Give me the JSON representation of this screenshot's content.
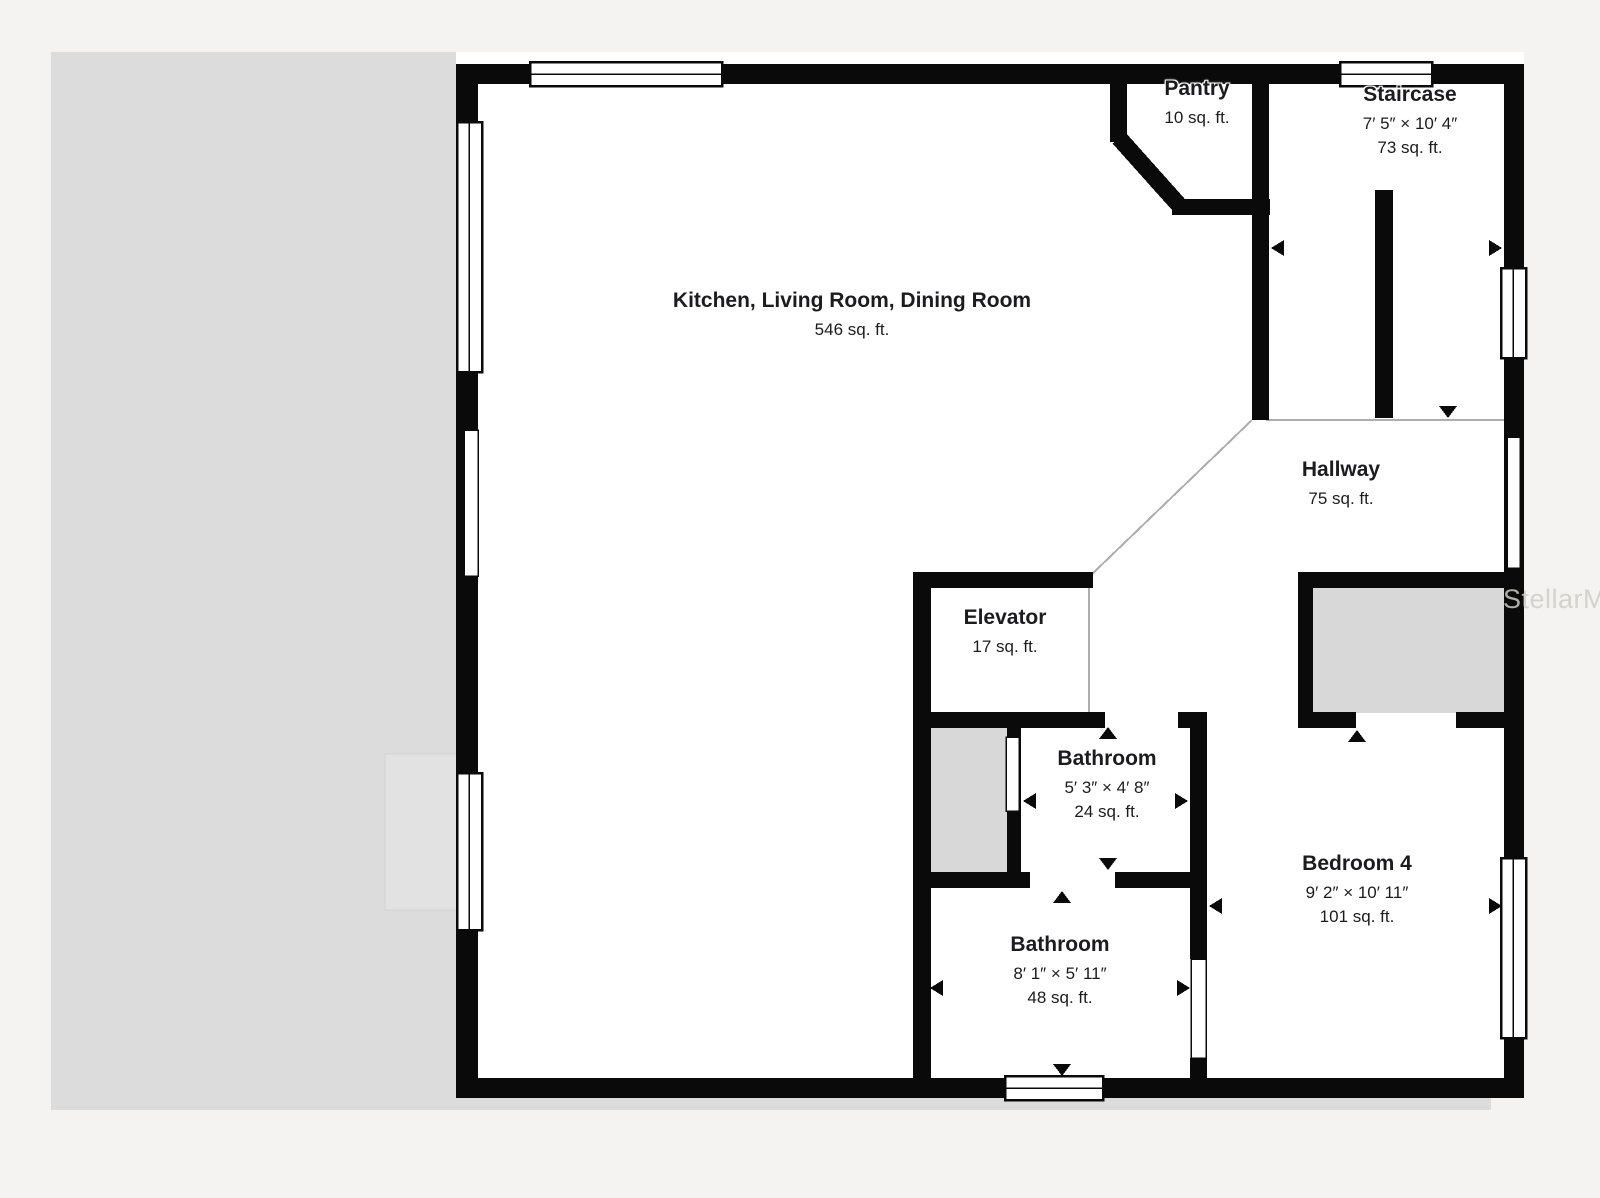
{
  "watermark": "StellarMLS",
  "rooms": [
    {
      "id": "kitchen-living-dining",
      "label": "Kitchen, Living Room, Dining Room",
      "area": "546 sq. ft."
    },
    {
      "id": "pantry",
      "label": "Pantry",
      "area": "10 sq. ft."
    },
    {
      "id": "staircase",
      "label": "Staircase",
      "dims": "7′ 5″ × 10′ 4″",
      "area": "73 sq. ft."
    },
    {
      "id": "hallway",
      "label": "Hallway",
      "area": "75 sq. ft."
    },
    {
      "id": "elevator",
      "label": "Elevator",
      "area": "17 sq. ft."
    },
    {
      "id": "bathroom-small",
      "label": "Bathroom",
      "dims": "5′ 3″ × 4′ 8″",
      "area": "24 sq. ft."
    },
    {
      "id": "bathroom-large",
      "label": "Bathroom",
      "dims": "8′ 1″ × 5′ 11″",
      "area": "48 sq. ft."
    },
    {
      "id": "bedroom-4",
      "label": "Bedroom 4",
      "dims": "9′ 2″ × 10′ 11″",
      "area": "101 sq. ft."
    }
  ],
  "colors": {
    "wall": "#0a0a0a",
    "room_fill": "#ffffff",
    "closet_fill": "#d8d8d8",
    "backdrop_gray": "#dcdcdc",
    "page_background": "#f4f3f1",
    "text": "#1c1c1e",
    "watermark": "#cdccc7",
    "open_boundary_line": "#aeaeae"
  },
  "symbols": {
    "door_arrow_icon": "small black triangle marking a door opening",
    "window_icon": "white double-pane rectangle set in wall",
    "door_slab_icon": "thin white slab set in wall"
  }
}
